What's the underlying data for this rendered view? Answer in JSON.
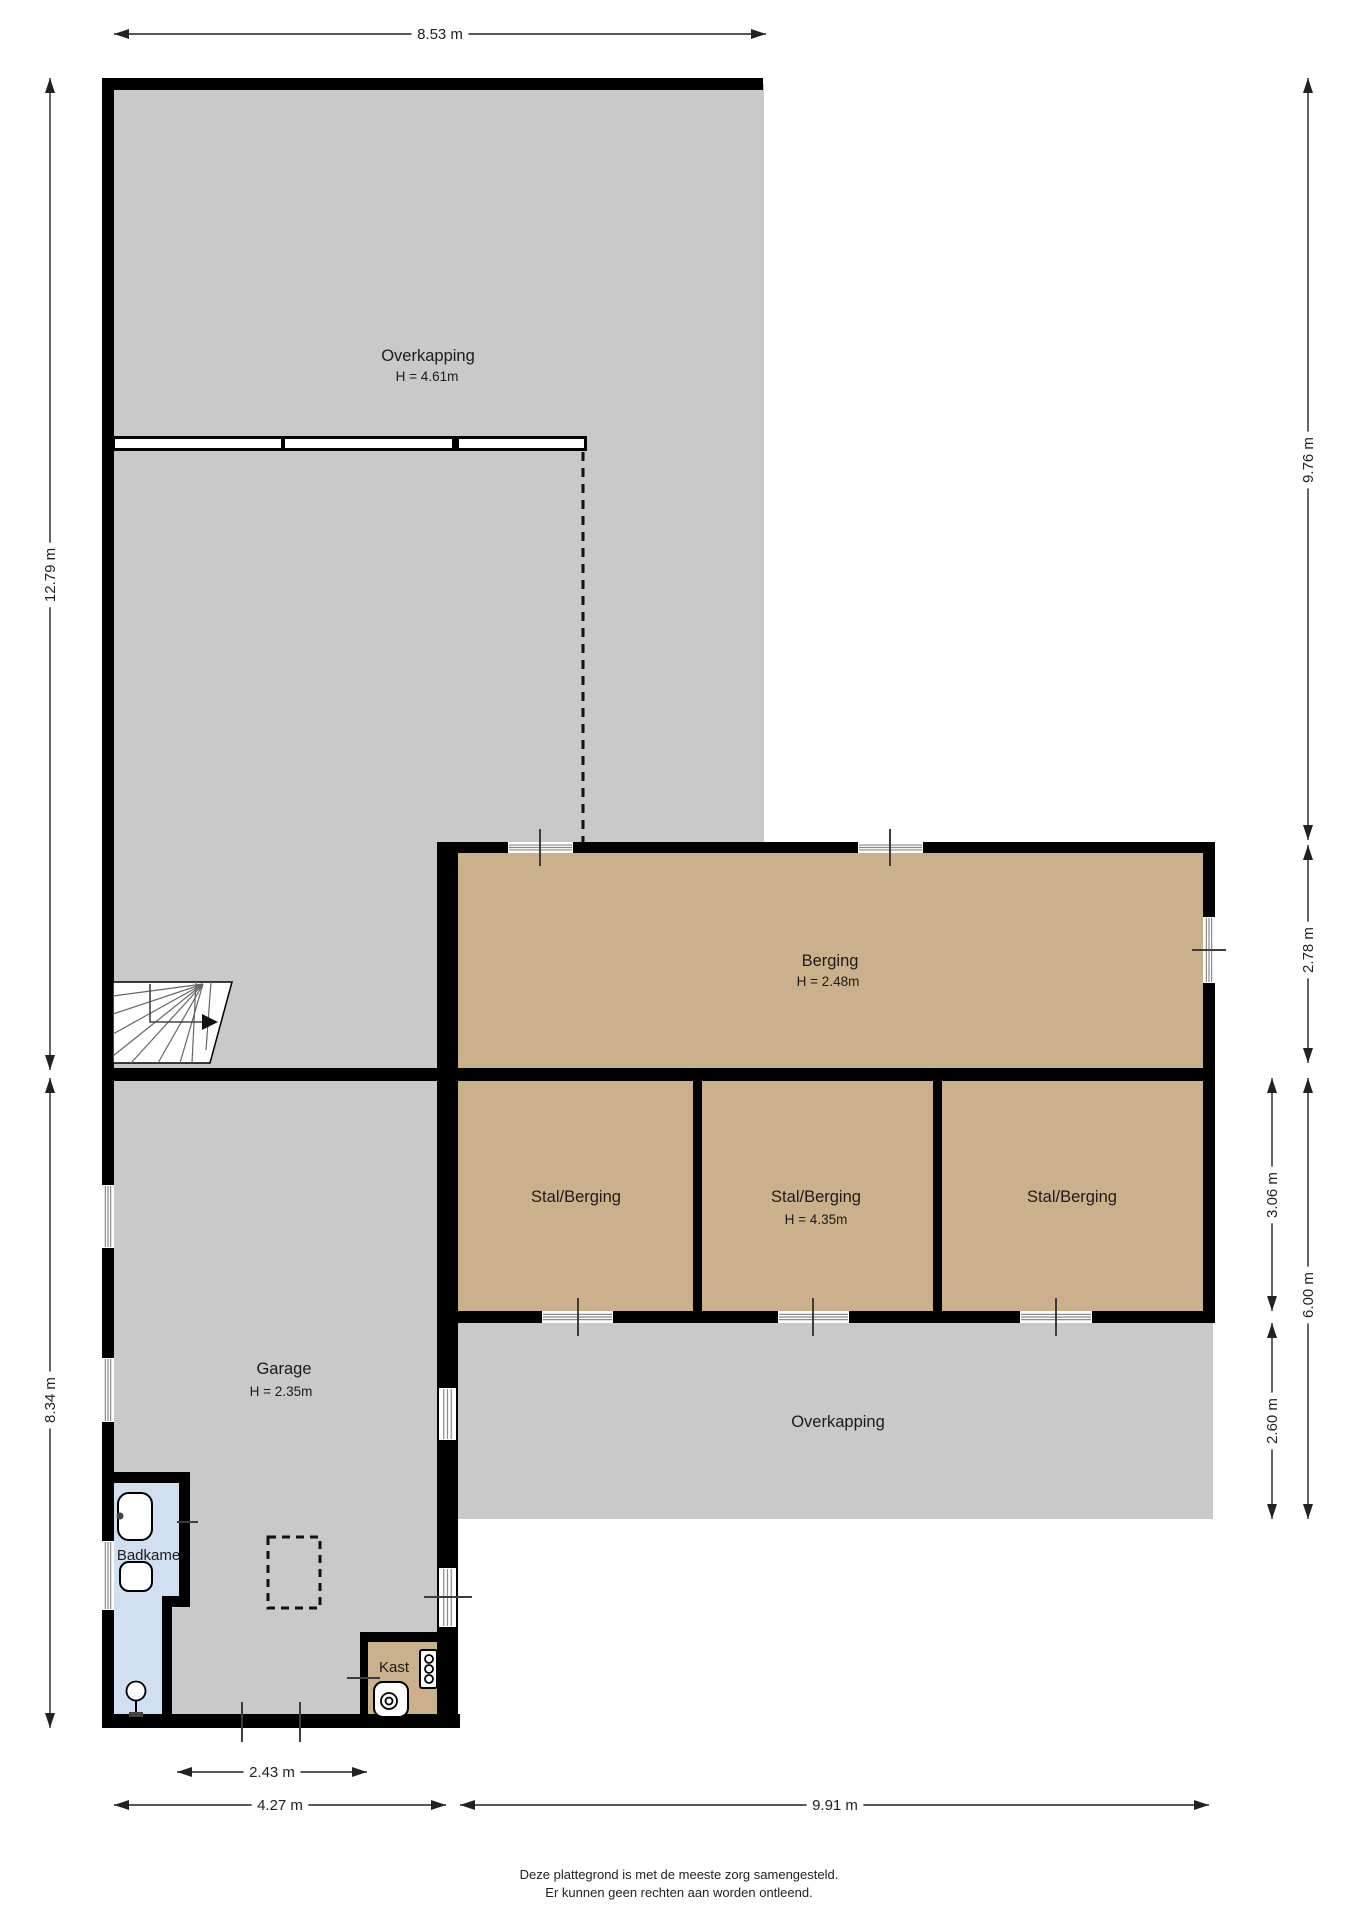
{
  "canvas": {
    "width": 1358,
    "height": 1920,
    "bg": "#ffffff"
  },
  "colors": {
    "wall": "#000000",
    "gray": "#c9c9c9",
    "tan": "#cab18b",
    "blue": "#d0e0f0",
    "hatch": "#8a8a8a",
    "tick": "#3d3d3d",
    "dim": "#222222",
    "text": "#1b1b1b"
  },
  "floors": [
    {
      "name": "floor-overkapping-top",
      "f": "gray",
      "x": 108,
      "y": 84,
      "w": 656,
      "h": 762
    },
    {
      "name": "floor-overkapping-top-left",
      "f": "gray",
      "x": 108,
      "y": 844,
      "w": 340,
      "h": 230
    },
    {
      "name": "floor-garage",
      "f": "gray",
      "x": 108,
      "y": 1074,
      "w": 340,
      "h": 648
    },
    {
      "name": "floor-overkapping-bottom",
      "f": "gray",
      "x": 458,
      "y": 1320,
      "w": 755,
      "h": 199
    },
    {
      "name": "floor-berging",
      "f": "tan",
      "x": 448,
      "y": 848,
      "w": 760,
      "h": 226
    },
    {
      "name": "floor-stal-berging-1",
      "f": "tan",
      "x": 452,
      "y": 1074,
      "w": 246,
      "h": 243
    },
    {
      "name": "floor-stal-berging-2",
      "f": "tan",
      "x": 698,
      "y": 1074,
      "w": 240,
      "h": 243
    },
    {
      "name": "floor-stal-berging-3",
      "f": "tan",
      "x": 938,
      "y": 1074,
      "w": 270,
      "h": 243
    },
    {
      "name": "floor-badkamer-upper",
      "f": "blue",
      "x": 112,
      "y": 1478,
      "w": 67,
      "h": 130
    },
    {
      "name": "floor-badkamer-lower",
      "f": "blue",
      "x": 112,
      "y": 1600,
      "w": 50,
      "h": 117
    },
    {
      "name": "floor-kast",
      "f": "tan",
      "x": 364,
      "y": 1636,
      "w": 74,
      "h": 82
    }
  ],
  "walls": [
    {
      "name": "wall-top",
      "x": 102,
      "y": 78,
      "w": 661,
      "h": 12
    },
    {
      "name": "wall-left",
      "x": 102,
      "y": 78,
      "w": 12,
      "h": 1650
    },
    {
      "name": "wall-berging-top",
      "x": 439,
      "y": 842,
      "w": 776,
      "h": 11
    },
    {
      "name": "wall-right",
      "x": 1203,
      "y": 842,
      "w": 12,
      "h": 481
    },
    {
      "name": "wall-middle",
      "x": 102,
      "y": 1068,
      "w": 1113,
      "h": 13
    },
    {
      "name": "wall-garage-right",
      "x": 437,
      "y": 842,
      "w": 21,
      "h": 886
    },
    {
      "name": "wall-stal-divider-1",
      "x": 693,
      "y": 1081,
      "w": 9,
      "h": 242
    },
    {
      "name": "wall-stal-divider-2",
      "x": 933,
      "y": 1081,
      "w": 9,
      "h": 242
    },
    {
      "name": "wall-stal-bottom",
      "x": 458,
      "y": 1311,
      "w": 757,
      "h": 12
    },
    {
      "name": "wall-badkamer-top",
      "x": 112,
      "y": 1472,
      "w": 78,
      "h": 11
    },
    {
      "name": "wall-badkamer-right-upper",
      "x": 179,
      "y": 1483,
      "w": 11,
      "h": 117
    },
    {
      "name": "wall-badkamer-jog",
      "x": 162,
      "y": 1596,
      "w": 28,
      "h": 11
    },
    {
      "name": "wall-badkamer-right-lower",
      "x": 162,
      "y": 1607,
      "w": 10,
      "h": 110
    },
    {
      "name": "wall-kast-top",
      "x": 360,
      "y": 1632,
      "w": 77,
      "h": 10
    },
    {
      "name": "wall-kast-left",
      "x": 360,
      "y": 1642,
      "w": 8,
      "h": 75
    },
    {
      "name": "wall-bottom",
      "x": 102,
      "y": 1714,
      "w": 358,
      "h": 14
    }
  ],
  "window_band": {
    "name": "window-band-overkapping",
    "x": 112,
    "y": 436,
    "w": 475,
    "h": 15,
    "segments": [
      [
        115,
        166
      ],
      [
        285,
        167
      ],
      [
        459,
        125
      ]
    ]
  },
  "windows": [
    {
      "name": "window-garage-left-1",
      "dir": "v",
      "x": 102,
      "y": 1185,
      "w": 12,
      "h": 63,
      "tick": null
    },
    {
      "name": "window-garage-left-2",
      "dir": "v",
      "x": 102,
      "y": 1358,
      "w": 12,
      "h": 64,
      "tick": null
    },
    {
      "name": "window-badkamer-left",
      "dir": "v",
      "x": 102,
      "y": 1541,
      "w": 12,
      "h": 69,
      "tick": null
    },
    {
      "name": "window-berging-top-1",
      "dir": "h",
      "x": 508,
      "y": 842,
      "w": 65,
      "h": 11,
      "tick": {
        "x1": 540,
        "y1": 829,
        "x2": 540,
        "y2": 866
      }
    },
    {
      "name": "window-berging-top-2",
      "dir": "h",
      "x": 858,
      "y": 842,
      "w": 65,
      "h": 11,
      "tick": {
        "x1": 890,
        "y1": 829,
        "x2": 890,
        "y2": 866
      }
    },
    {
      "name": "window-berging-right",
      "dir": "v",
      "x": 1203,
      "y": 917,
      "w": 12,
      "h": 66,
      "tick": {
        "x1": 1192,
        "y1": 950,
        "x2": 1226,
        "y2": 950
      }
    },
    {
      "name": "door-stal-1",
      "dir": "h",
      "x": 542,
      "y": 1311,
      "w": 71,
      "h": 12,
      "tick": {
        "x1": 578,
        "y1": 1298,
        "x2": 578,
        "y2": 1336
      }
    },
    {
      "name": "door-stal-2",
      "dir": "h",
      "x": 778,
      "y": 1311,
      "w": 71,
      "h": 12,
      "tick": {
        "x1": 813,
        "y1": 1298,
        "x2": 813,
        "y2": 1336
      }
    },
    {
      "name": "door-stal-3",
      "dir": "h",
      "x": 1020,
      "y": 1311,
      "w": 72,
      "h": 12,
      "tick": {
        "x1": 1056,
        "y1": 1298,
        "x2": 1056,
        "y2": 1336
      }
    },
    {
      "name": "window-garage-right-1",
      "dir": "v",
      "x": 439,
      "y": 1388,
      "w": 17,
      "h": 52,
      "tick": null
    },
    {
      "name": "door-garage-right-2",
      "dir": "v",
      "x": 439,
      "y": 1568,
      "w": 17,
      "h": 59,
      "tick": {
        "x1": 424,
        "y1": 1597,
        "x2": 472,
        "y2": 1597
      }
    }
  ],
  "ticks": [
    {
      "name": "tick-badkamer-vent",
      "x1": 177,
      "y1": 1522,
      "x2": 198,
      "y2": 1522
    },
    {
      "name": "tick-kast-door",
      "x1": 347,
      "y1": 1678,
      "x2": 380,
      "y2": 1678
    },
    {
      "name": "tick-garage-door-1",
      "x1": 242,
      "y1": 1702,
      "x2": 242,
      "y2": 1742
    },
    {
      "name": "tick-garage-door-2",
      "x1": 300,
      "y1": 1702,
      "x2": 300,
      "y2": 1742
    }
  ],
  "dashed_line": {
    "name": "roof-edge-dashed-line",
    "x1": 583,
    "y1": 452,
    "x2": 583,
    "y2": 842
  },
  "dashed_rect": {
    "name": "garage-hatch-dashed-rect",
    "x": 268,
    "y": 1537,
    "w": 52,
    "h": 71
  },
  "stair": {
    "name": "staircase",
    "outline": "113,982 232,982 210,1063 113,1063",
    "lines": [
      [
        203,
        984,
        113,
        996
      ],
      [
        203,
        984,
        113,
        1014
      ],
      [
        203,
        984,
        113,
        1034
      ],
      [
        203,
        984,
        113,
        1056
      ],
      [
        203,
        984,
        131,
        1063
      ],
      [
        203,
        984,
        158,
        1063
      ],
      [
        203,
        984,
        180,
        1063
      ],
      [
        196,
        982,
        192,
        1063
      ],
      [
        211,
        982,
        206,
        1050
      ]
    ],
    "walk_path": "M150,984 L150,1022 L203,1022",
    "walk_arrow": "218,1022 202,1014 202,1030"
  },
  "fixtures": [
    {
      "k": "rrect",
      "name": "sink",
      "x": 118,
      "y": 1493,
      "w": 34,
      "h": 47,
      "rx": 11
    },
    {
      "k": "circle",
      "name": "sink-faucet",
      "cx": 120,
      "cy": 1516,
      "r": 3.5,
      "fill": "#444444"
    },
    {
      "k": "rrect",
      "name": "toilet",
      "x": 120,
      "y": 1562,
      "w": 32,
      "h": 29,
      "rx": 9
    },
    {
      "k": "circle",
      "name": "shower-head",
      "cx": 136,
      "cy": 1691,
      "r": 9.5
    },
    {
      "k": "line",
      "name": "shower-stem",
      "x1": 136,
      "y1": 1700,
      "x2": 136,
      "y2": 1713
    },
    {
      "k": "rect",
      "name": "shower-base",
      "x": 129,
      "y": 1712,
      "w": 14,
      "h": 5,
      "fill": "#444444"
    },
    {
      "k": "rrect",
      "name": "washer-unit",
      "x": 420,
      "y": 1650,
      "w": 17,
      "h": 38,
      "rx": 2
    },
    {
      "k": "circle",
      "name": "washer-knob-1",
      "cx": 429,
      "cy": 1659,
      "r": 4
    },
    {
      "k": "circle",
      "name": "washer-knob-2",
      "cx": 429,
      "cy": 1669,
      "r": 4
    },
    {
      "k": "circle",
      "name": "washer-knob-3",
      "cx": 429,
      "cy": 1679,
      "r": 4
    },
    {
      "k": "rrect",
      "name": "boiler",
      "x": 374,
      "y": 1682,
      "w": 34,
      "h": 35,
      "rx": 9
    },
    {
      "k": "circle",
      "name": "boiler-ring-outer",
      "cx": 389,
      "cy": 1701,
      "r": 8
    },
    {
      "k": "circle",
      "name": "boiler-ring-inner",
      "cx": 389,
      "cy": 1701,
      "r": 3.5
    }
  ],
  "room_labels": [
    {
      "id": "overkapping-top",
      "text": "Overkapping",
      "sub": "H = 4.61m",
      "x": 428,
      "y": 356,
      "sx": 427,
      "sy": 376
    },
    {
      "id": "berging",
      "text": "Berging",
      "sub": "H = 2.48m",
      "x": 830,
      "y": 961,
      "sx": 828,
      "sy": 981
    },
    {
      "id": "stal-berging-1",
      "text": "Stal/Berging",
      "sub": null,
      "x": 576,
      "y": 1197
    },
    {
      "id": "stal-berging-2",
      "text": "Stal/Berging",
      "sub": "H = 4.35m",
      "x": 816,
      "y": 1197,
      "sx": 816,
      "sy": 1219
    },
    {
      "id": "stal-berging-3",
      "text": "Stal/Berging",
      "sub": null,
      "x": 1072,
      "y": 1197
    },
    {
      "id": "garage",
      "text": "Garage",
      "sub": "H = 2.35m",
      "x": 284,
      "y": 1369,
      "sx": 281,
      "sy": 1391
    },
    {
      "id": "overkapping-bottom",
      "text": "Overkapping",
      "sub": null,
      "x": 838,
      "y": 1422
    },
    {
      "id": "badkamer",
      "text": "Badkamer",
      "sub": null,
      "x": 151,
      "y": 1555,
      "size": 15
    },
    {
      "id": "kast",
      "text": "Kast",
      "sub": null,
      "x": 394,
      "y": 1667,
      "size": 15
    }
  ],
  "dimensions": [
    {
      "id": "8-53",
      "label": "8.53 m",
      "x1": 114,
      "y1": 34,
      "x2": 766,
      "y2": 34,
      "lx": 440,
      "ly": 34
    },
    {
      "id": "12-79",
      "label": "12.79 m",
      "x1": 50,
      "y1": 78,
      "x2": 50,
      "y2": 1070,
      "lx": 50,
      "ly": 575
    },
    {
      "id": "8-34",
      "label": "8.34 m",
      "x1": 50,
      "y1": 1078,
      "x2": 50,
      "y2": 1728,
      "lx": 50,
      "ly": 1400
    },
    {
      "id": "9-76",
      "label": "9.76 m",
      "x1": 1308,
      "y1": 78,
      "x2": 1308,
      "y2": 840,
      "lx": 1308,
      "ly": 460
    },
    {
      "id": "2-78",
      "label": "2.78 m",
      "x1": 1308,
      "y1": 845,
      "x2": 1308,
      "y2": 1063,
      "lx": 1308,
      "ly": 950
    },
    {
      "id": "3-06",
      "label": "3.06 m",
      "x1": 1272,
      "y1": 1078,
      "x2": 1272,
      "y2": 1311,
      "lx": 1272,
      "ly": 1195
    },
    {
      "id": "6-00",
      "label": "6.00 m",
      "x1": 1308,
      "y1": 1078,
      "x2": 1308,
      "y2": 1519,
      "lx": 1308,
      "ly": 1295
    },
    {
      "id": "2-60",
      "label": "2.60 m",
      "x1": 1272,
      "y1": 1323,
      "x2": 1272,
      "y2": 1519,
      "lx": 1272,
      "ly": 1421
    },
    {
      "id": "2-43",
      "label": "2.43 m",
      "x1": 177,
      "y1": 1772,
      "x2": 367,
      "y2": 1772,
      "lx": 272,
      "ly": 1772
    },
    {
      "id": "4-27",
      "label": "4.27 m",
      "x1": 114,
      "y1": 1805,
      "x2": 446,
      "y2": 1805,
      "lx": 280,
      "ly": 1805
    },
    {
      "id": "9-91",
      "label": "9.91 m",
      "x1": 460,
      "y1": 1805,
      "x2": 1209,
      "y2": 1805,
      "lx": 835,
      "ly": 1805
    }
  ],
  "footer": {
    "line1": "Deze plattegrond is met de meeste zorg samengesteld.",
    "line2": "Er kunnen geen rechten aan worden ontleend."
  }
}
